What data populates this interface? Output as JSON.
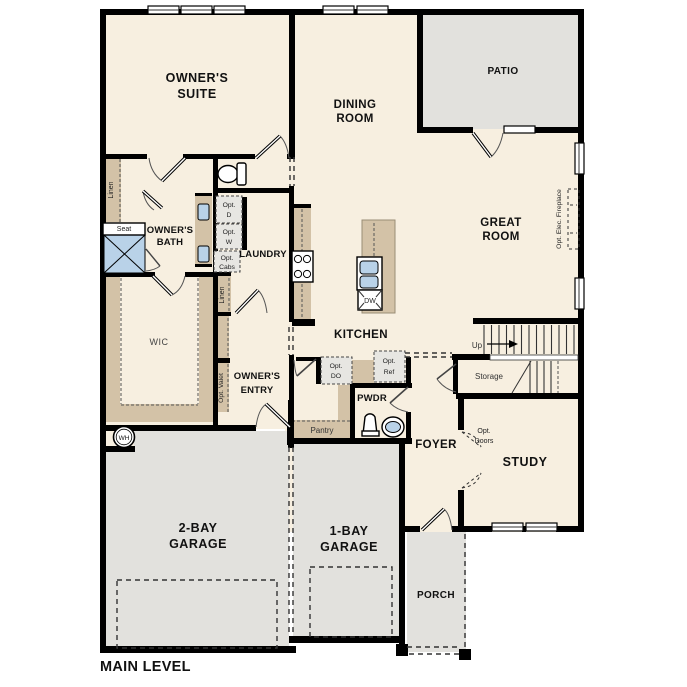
{
  "title": "MAIN LEVEL",
  "colors": {
    "wall": "#000000",
    "floor": "#f7efe0",
    "outdoor": "#e2e1dd",
    "cabinet": "#d3c2a7",
    "fixture_blue": "#b9d2e8",
    "option_fill": "#e7e6e2"
  },
  "labels": {
    "rooms": {
      "owners_suite_1": "OWNER'S",
      "owners_suite_2": "SUITE",
      "dining_1": "DINING",
      "dining_2": "ROOM",
      "patio": "PATIO",
      "great_1": "GREAT",
      "great_2": "ROOM",
      "kitchen": "KITCHEN",
      "laundry": "LAUNDRY",
      "owners_bath_1": "OWNER'S",
      "owners_bath_2": "BATH",
      "wic": "WIC",
      "owners_entry_1": "OWNER'S",
      "owners_entry_2": "ENTRY",
      "pwdr": "PWDR",
      "foyer": "FOYER",
      "study": "STUDY",
      "storage": "Storage",
      "pantry": "Pantry",
      "garage2_1": "2-BAY",
      "garage2_2": "GARAGE",
      "garage1_1": "1-BAY",
      "garage1_2": "GARAGE",
      "porch": "PORCH"
    },
    "features": {
      "seat": "Seat",
      "linen_suite": "Linen",
      "linen_hall": "Linen",
      "dw": "DW",
      "wh": "WH",
      "up": "Up",
      "main_level": "MAIN LEVEL"
    },
    "options": {
      "opt_d_1": "Opt.",
      "opt_d_2": "D",
      "opt_w_1": "Opt.",
      "opt_w_2": "W",
      "opt_cabs_1": "Opt.",
      "opt_cabs_2": "Cabs",
      "opt_valet": "Opt. Valet",
      "opt_do_1": "Opt.",
      "opt_do_2": "DO",
      "opt_ref_1": "Opt.",
      "opt_ref_2": "Ref",
      "opt_doors_1": "Opt.",
      "opt_doors_2": "Doors",
      "opt_fireplace": "Opt. Elec. Fireplace"
    }
  }
}
